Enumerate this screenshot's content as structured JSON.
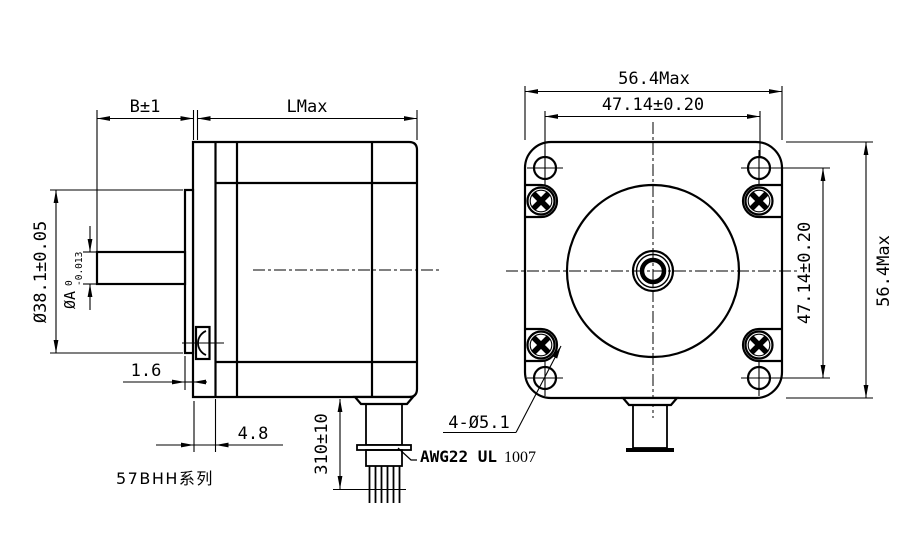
{
  "colors": {
    "line": "#000000",
    "background": "#ffffff"
  },
  "series_label": "57BHH系列",
  "side_view": {
    "dim_b": "B±1",
    "dim_l": "LMax",
    "dim_boss_dia": "Ø38.1±0.05",
    "dim_shaft_dia": "ØA",
    "shaft_tol_upper": "0",
    "shaft_tol_lower": "-0.013",
    "dim_boss_height": "1.6",
    "dim_flange_depth": "4.8",
    "dim_lead_length": "310±10",
    "lead_wire_label": "AWG22 UL",
    "lead_wire_label_suffix": "1007"
  },
  "front_view": {
    "dim_width_max": "56.4Max",
    "dim_hole_pitch_h": "47.14±0.20",
    "dim_hole_pitch_v": "47.14±0.20",
    "dim_height_max": "56.4Max",
    "dim_mounting_holes": "4-Ø5.1"
  }
}
